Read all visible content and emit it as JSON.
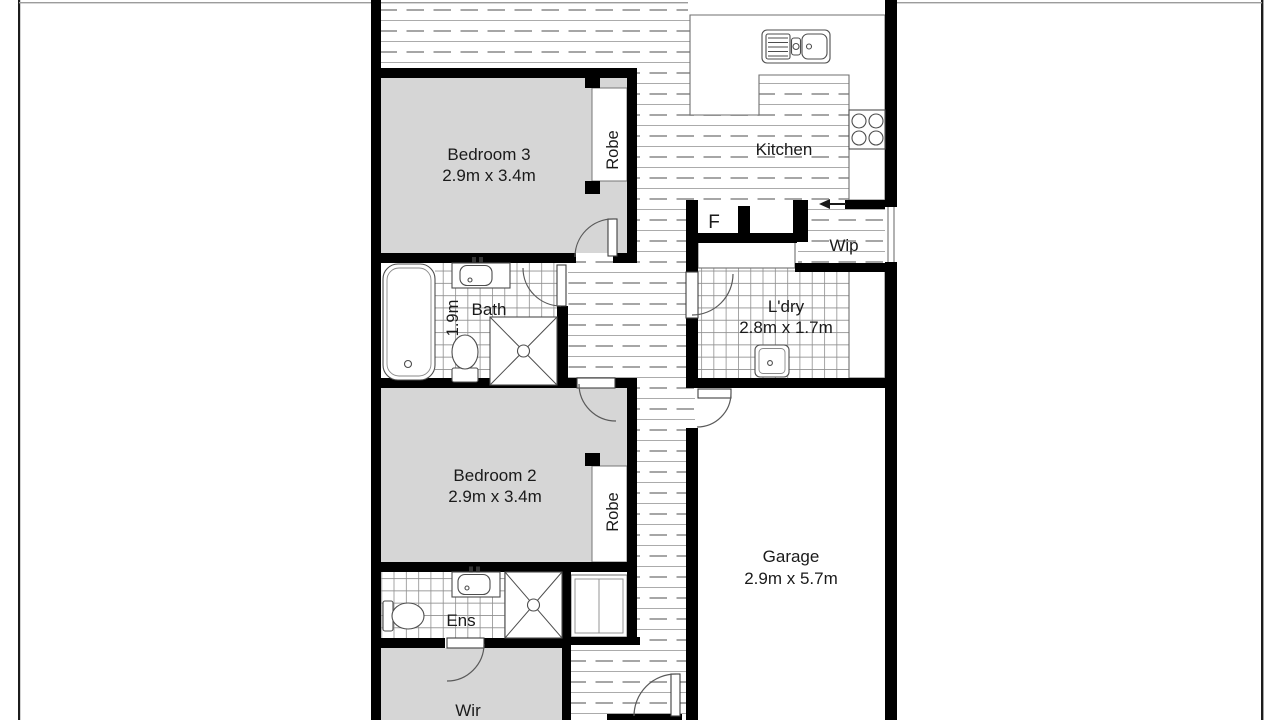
{
  "plan_title": "Residential floor plan (cropped)",
  "palette": {
    "wall": "#000000",
    "bedroom_fill": "#d6d6d6",
    "floorboard_solid_line": "#ababab",
    "floorboard_dash_line": "#9a9a9a",
    "tile_line": "#8f8f8f",
    "fixture_line": "#4d4d4d",
    "text": "#1a1a1a",
    "page_border": "#1c1c1c"
  },
  "rooms": {
    "bedroom3": {
      "name": "Bedroom 3",
      "dims": "2.9m x 3.4m"
    },
    "robe3": {
      "name": "Robe"
    },
    "kitchen": {
      "name": "Kitchen"
    },
    "fridge": {
      "name": "F"
    },
    "wip": {
      "name": "Wip"
    },
    "bath": {
      "name": "Bath",
      "dims": "1.9m"
    },
    "laundry": {
      "name": "L'dry",
      "dims": "2.8m x 1.7m"
    },
    "bedroom2": {
      "name": "Bedroom 2",
      "dims": "2.9m x 3.4m"
    },
    "robe2": {
      "name": "Robe"
    },
    "garage": {
      "name": "Garage",
      "dims": "2.9m x 5.7m"
    },
    "ensuite": {
      "name": "Ens"
    },
    "wir": {
      "name": "Wir"
    }
  },
  "fixtures": [
    "kitchen-sink",
    "cooktop",
    "entry-arrow",
    "bathtub",
    "bath-vanity",
    "bath-toilet",
    "bath-shower",
    "laundry-tub",
    "linen-cupboard",
    "ens-vanity",
    "ens-toilet",
    "ens-shower"
  ]
}
